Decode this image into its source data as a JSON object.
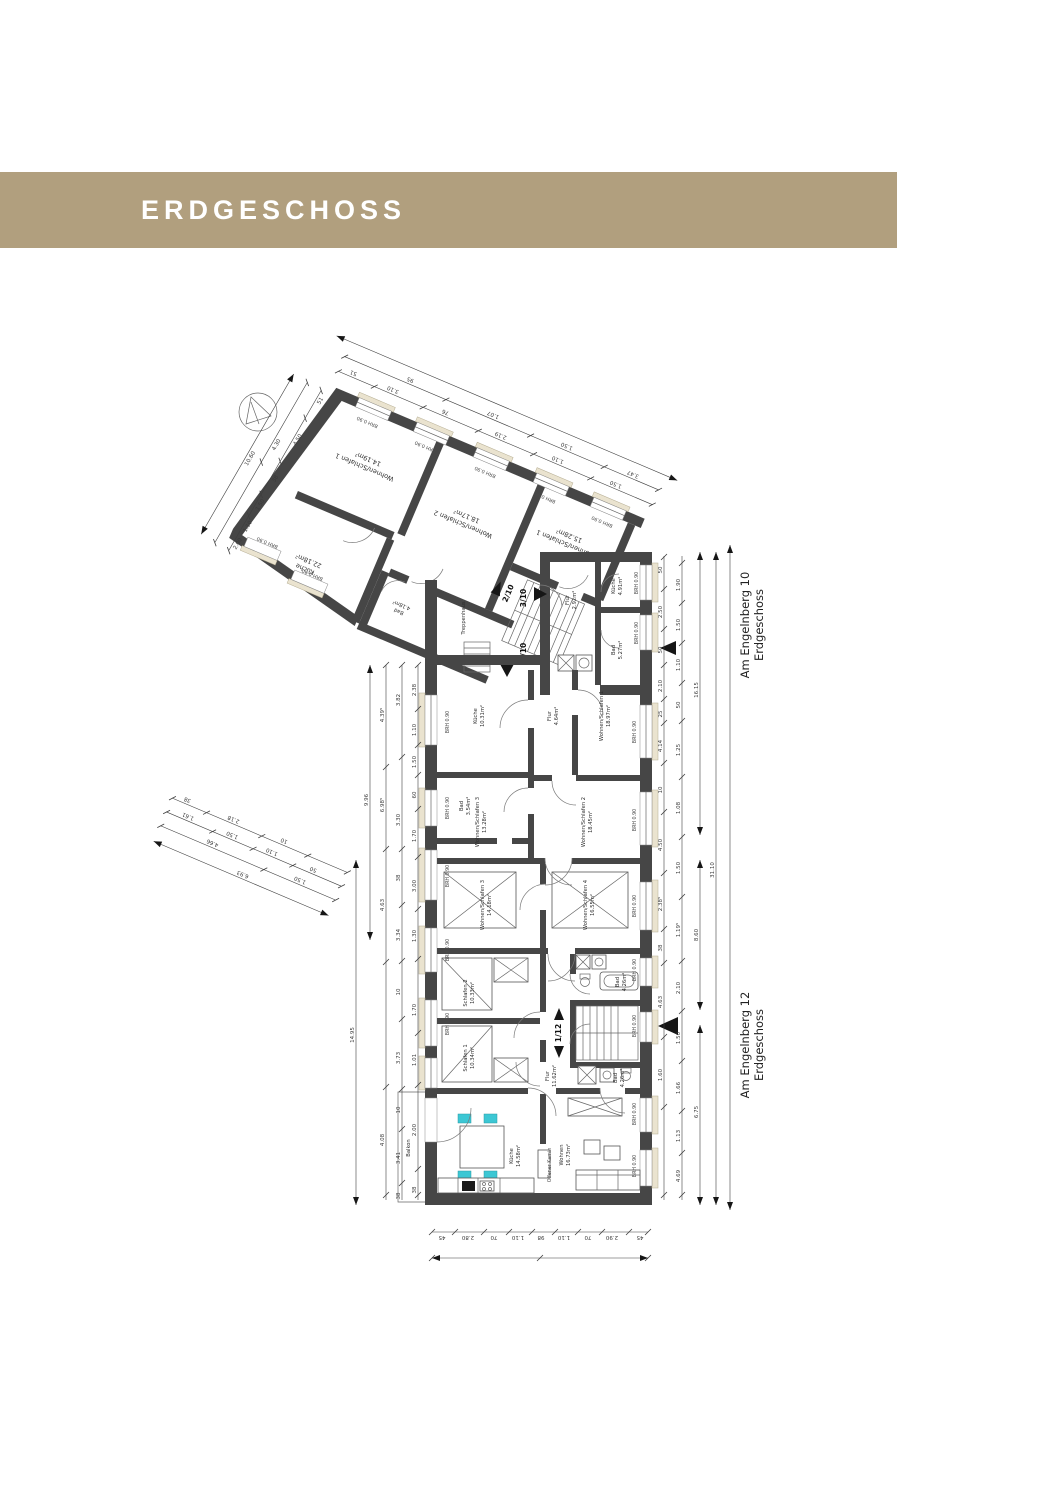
{
  "header": {
    "title": "ERDGESCHOSS",
    "background": "#b19f7e",
    "text_color": "#ffffff"
  },
  "plan": {
    "wall_color": "#464646",
    "sill_color": "#eae3cf",
    "accent_teal": "#3cc7d4",
    "brh_label": "BRH 0.90",
    "stairwell_label": "Treppenhaus",
    "balcony_label": "Balkon",
    "fireplace_label": "Offener Kamin",
    "buildings": [
      {
        "street": "Am Engelnberg 10",
        "floor": "Erdgeschoss"
      },
      {
        "street": "Am Engelnberg 12",
        "floor": "Erdgeschoss"
      }
    ],
    "unit_markers": [
      "2/10",
      "3/10",
      "1/10",
      "1/12"
    ],
    "rooms": [
      {
        "name": "Wohnen/Schlafen 1",
        "area": "14.19m²"
      },
      {
        "name": "Wohnen/Schlafen 2",
        "area": "18.17m²"
      },
      {
        "name": "Wohnen/Schlafen 1",
        "area": "15.28m²"
      },
      {
        "name": "Küche",
        "area": "22.18m²"
      },
      {
        "name": "Bad",
        "area": "4.18m²"
      },
      {
        "name": "Flur",
        "area": "2.92m²"
      },
      {
        "name": "Küche",
        "area": "4.91m²"
      },
      {
        "name": "Bad",
        "area": "5.27m²"
      },
      {
        "name": "Küche",
        "area": "10.31m²"
      },
      {
        "name": "Flur",
        "area": "4.64m²"
      },
      {
        "name": "Wohnen/Schlafen 1",
        "area": "18.97m²"
      },
      {
        "name": "Bad",
        "area": "3.54m²"
      },
      {
        "name": "Wohnen/Schlafen 3",
        "area": "13.28m²"
      },
      {
        "name": "Wohnen/Schlafen 2",
        "area": "18.45m²"
      },
      {
        "name": "Wohnen/Schlafen 3",
        "area": "14.18m²"
      },
      {
        "name": "Wohnen/Schlafen 4",
        "area": "16.55m²"
      },
      {
        "name": "Schlafen 2",
        "area": "10.33m²"
      },
      {
        "name": "Schlafen 1",
        "area": "10.34m²"
      },
      {
        "name": "Bad",
        "area": "4.26m²"
      },
      {
        "name": "Flur",
        "area": "11.62m²"
      },
      {
        "name": "Bad",
        "area": "4.26m²"
      },
      {
        "name": "Küche",
        "area": "14.58m²"
      },
      {
        "name": "Wohnen",
        "area": "16.73m²"
      }
    ],
    "dims": {
      "top": [
        "51",
        "3.10",
        "76",
        "2.19",
        "1.10",
        "1.50"
      ],
      "top2": [
        "95",
        "1.07",
        "1.50",
        "3.47"
      ],
      "left_upper": [
        "51",
        "4.50",
        "38",
        "1.50",
        "1.10",
        "2.00",
        "4.30",
        "10.60"
      ],
      "left_block": [
        "38",
        "2.18",
        "10",
        "1.61",
        "1.50",
        "1.10",
        "50",
        "4.66",
        "1.50",
        "6.93"
      ],
      "left": [
        "2.38",
        "1.10",
        "1.50",
        "60",
        "1.70",
        "3.00",
        "1.30",
        "1.70",
        "1.01",
        "2.00",
        "38"
      ],
      "left2": [
        "3.82",
        "3.30",
        "38",
        "3.34",
        "10",
        "3.73",
        "10",
        "3.41",
        "38"
      ],
      "left3": [
        "4.39⁵",
        "6.98⁵",
        "4.63",
        "4.08"
      ],
      "left_totals": [
        "9.96",
        "14.95"
      ],
      "right": [
        "50",
        "2.50",
        "50",
        "2.10",
        "25",
        "4.14",
        "10",
        "4.50",
        "2.38⁵",
        "38",
        "4.63",
        "1.60"
      ],
      "right2": [
        "1.90",
        "1.50",
        "1.10",
        "50",
        "1.25",
        "1.08",
        "1.50",
        "1.19⁵",
        "2.10",
        "1.50",
        "1.66",
        "1.13",
        "4.69"
      ],
      "right_totals": [
        "16.15",
        "8.60",
        "6.75",
        "31.10"
      ],
      "bottom": [
        "45",
        "2.80",
        "70",
        "1.10",
        "98",
        "1.10",
        "70",
        "2.90",
        "45"
      ]
    }
  }
}
